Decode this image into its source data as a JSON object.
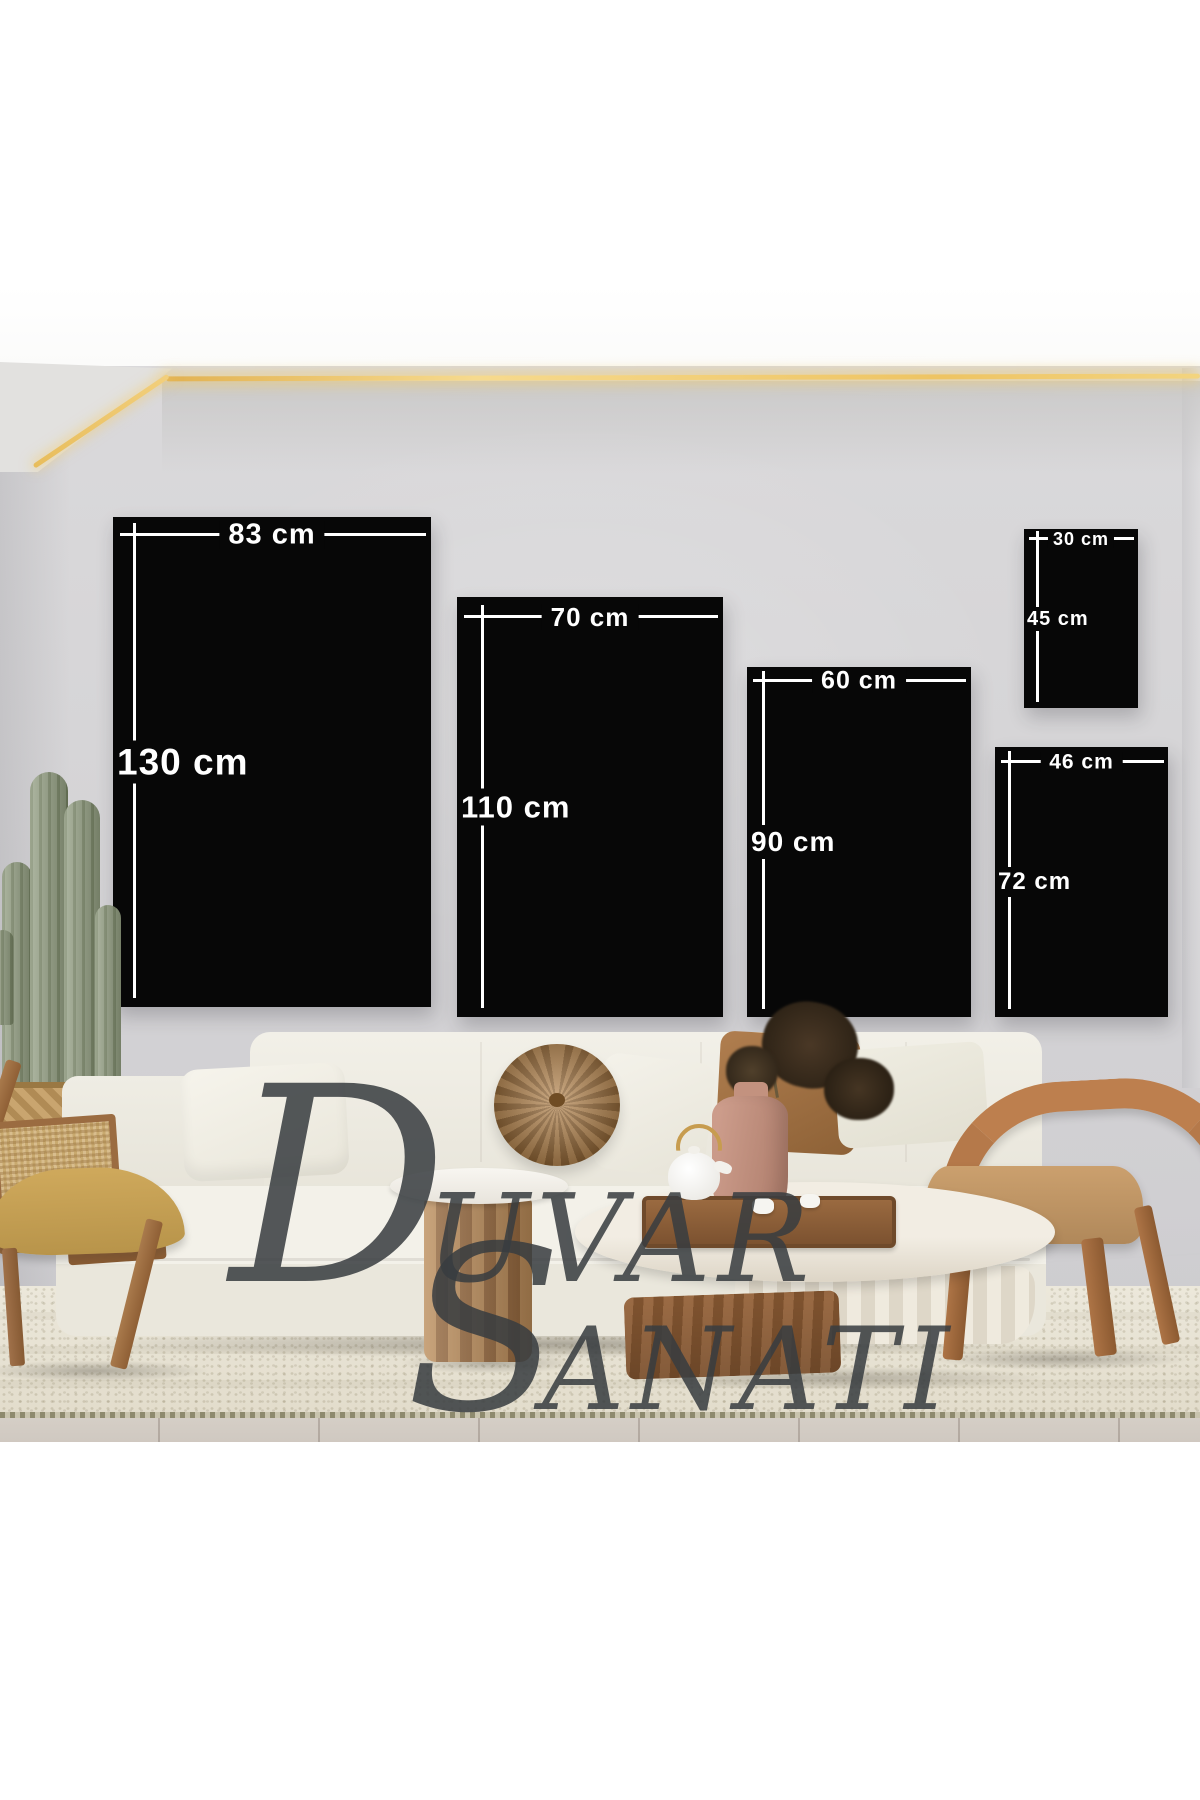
{
  "watermark": {
    "line1": "Duvar",
    "line2": "Sanati",
    "line1_initial": "D",
    "line1_rest": "UVAR",
    "line2_initial": "S",
    "line2_rest": "ANATI"
  },
  "panels": [
    {
      "name": "canvas-83x130",
      "width_label": "83 cm",
      "height_label": "130 cm"
    },
    {
      "name": "canvas-70x110",
      "width_label": "70 cm",
      "height_label": "110 cm"
    },
    {
      "name": "canvas-60x90",
      "width_label": "60 cm",
      "height_label": "90 cm"
    },
    {
      "name": "canvas-46x72",
      "width_label": "46 cm",
      "height_label": "72 cm"
    },
    {
      "name": "canvas-30x45",
      "width_label": "30 cm",
      "height_label": "45 cm"
    }
  ],
  "colors": {
    "canvas": "#070707",
    "measurement": "#ffffff",
    "wall": "#d6d5d8",
    "led_strip": "#f0c763",
    "watermark": "#383c40",
    "sofa": "#f0eee6",
    "wood": "#a5714a",
    "rug": "#e8e3d5"
  }
}
